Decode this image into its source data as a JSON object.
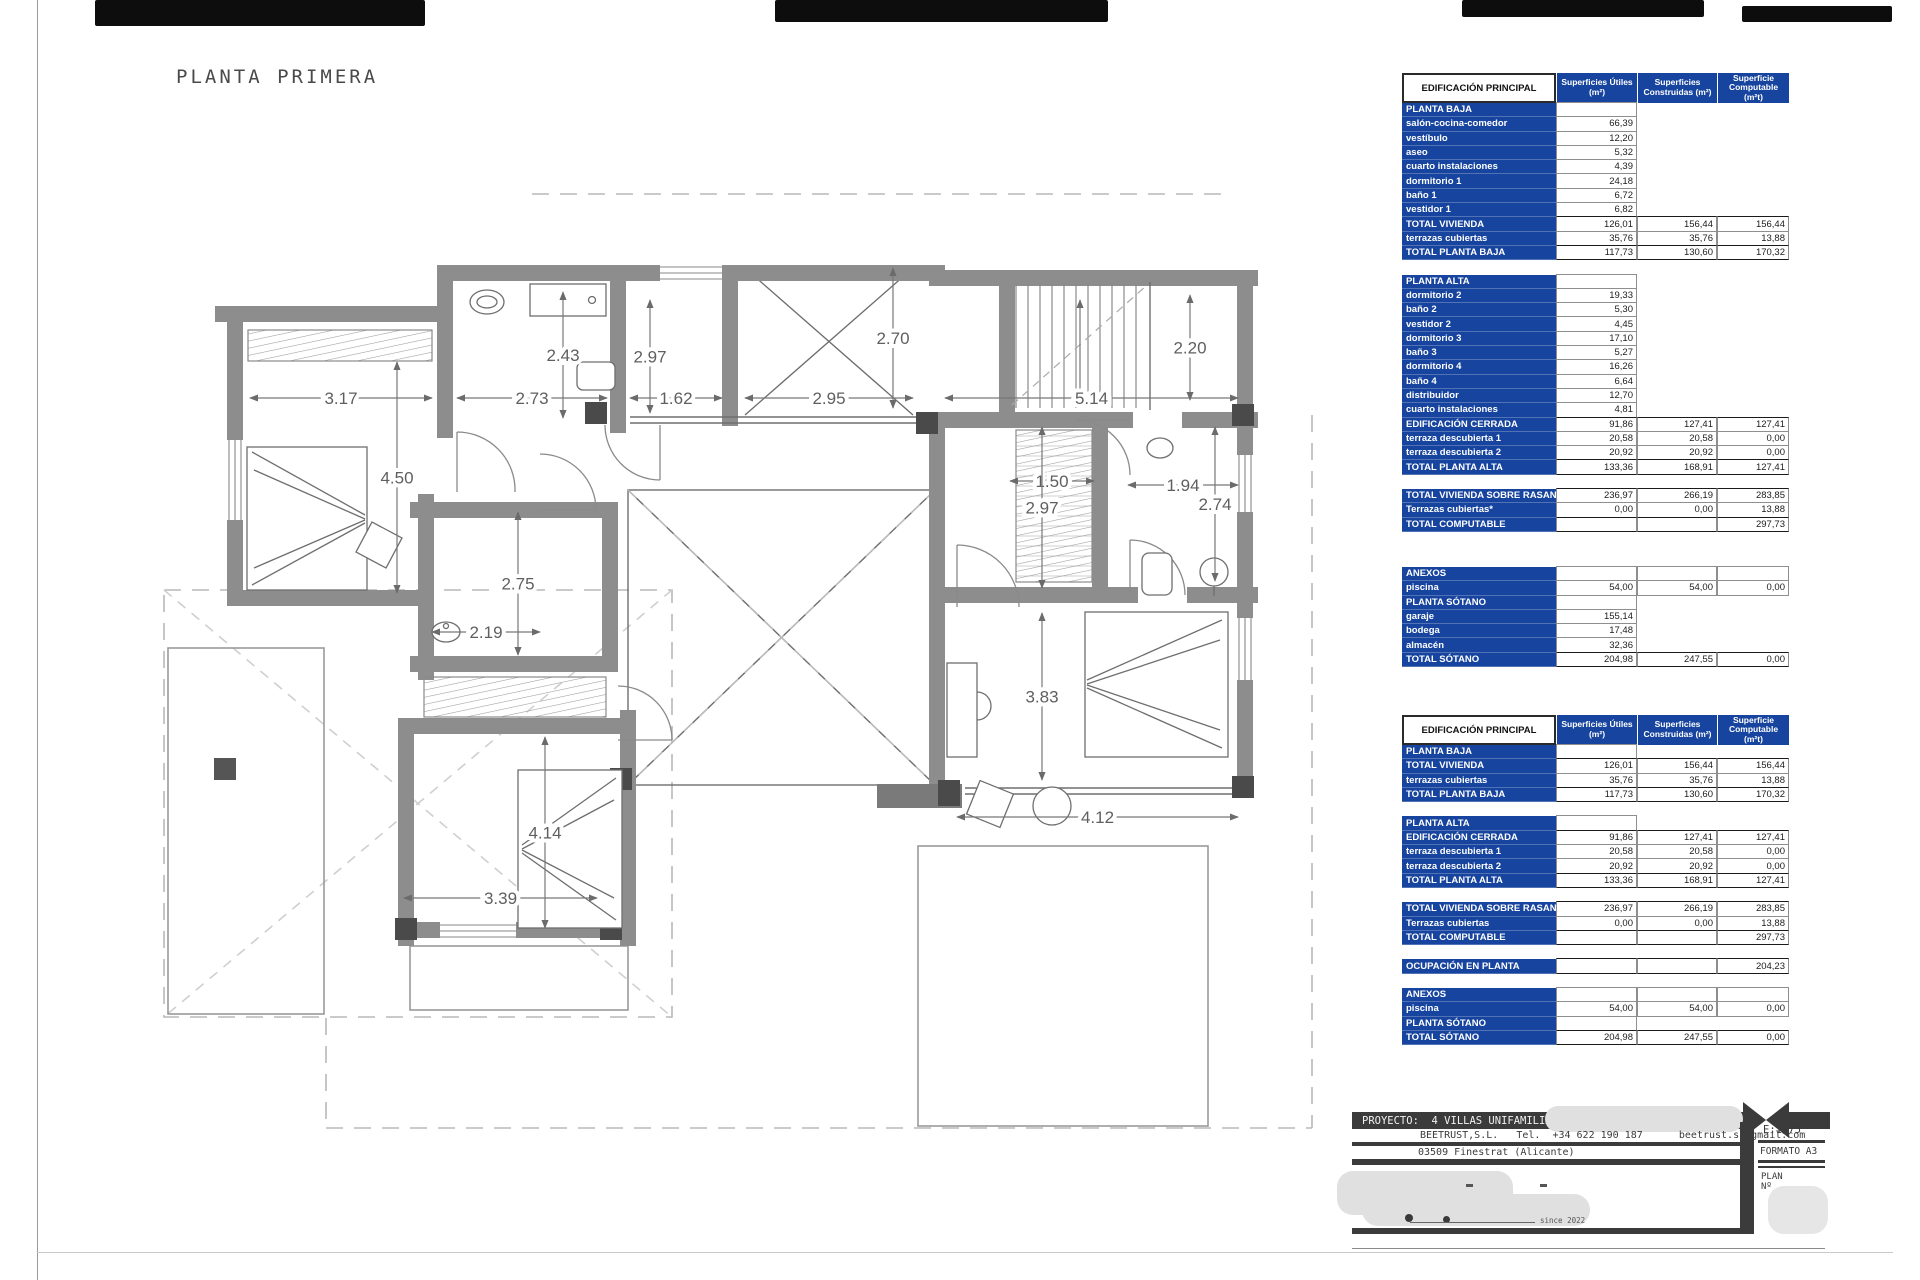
{
  "accent_blue": "#17449e",
  "sheet": {
    "plan_title": "PLANTA PRIMERA"
  },
  "plan": {
    "dimensions": [
      {
        "label": "3.17",
        "x1": 250,
        "y1": 398,
        "x2": 432,
        "y2": 398
      },
      {
        "label": "2.73",
        "x1": 457,
        "y1": 398,
        "x2": 607,
        "y2": 398
      },
      {
        "label": "1.62",
        "x1": 630,
        "y1": 398,
        "x2": 722,
        "y2": 398
      },
      {
        "label": "2.95",
        "x1": 745,
        "y1": 398,
        "x2": 913,
        "y2": 398
      },
      {
        "label": "5.14",
        "x1": 945,
        "y1": 398,
        "x2": 1238,
        "y2": 398
      },
      {
        "label": "2.43",
        "x1": 563,
        "y1": 292,
        "x2": 563,
        "y2": 418
      },
      {
        "label": "2.97",
        "x1": 650,
        "y1": 300,
        "x2": 650,
        "y2": 413
      },
      {
        "label": "2.70",
        "x1": 893,
        "y1": 268,
        "x2": 893,
        "y2": 408
      },
      {
        "label": "2.20",
        "x1": 1190,
        "y1": 295,
        "x2": 1190,
        "y2": 400
      },
      {
        "label": "4.50",
        "x1": 397,
        "y1": 362,
        "x2": 397,
        "y2": 593
      },
      {
        "label": "2.75",
        "x1": 518,
        "y1": 512,
        "x2": 518,
        "y2": 655
      },
      {
        "label": "2.19",
        "x1": 432,
        "y1": 632,
        "x2": 540,
        "y2": 632
      },
      {
        "label": "1.50",
        "x1": 1010,
        "y1": 481,
        "x2": 1094,
        "y2": 481
      },
      {
        "label": "1.94",
        "x1": 1128,
        "y1": 485,
        "x2": 1238,
        "y2": 485
      },
      {
        "label": "2.97",
        "x1": 1042,
        "y1": 427,
        "x2": 1042,
        "y2": 588
      },
      {
        "label": "2.74",
        "x1": 1215,
        "y1": 427,
        "x2": 1215,
        "y2": 581
      },
      {
        "label": "3.83",
        "x1": 1042,
        "y1": 613,
        "x2": 1042,
        "y2": 780
      },
      {
        "label": "4.12",
        "x1": 957,
        "y1": 817,
        "x2": 1238,
        "y2": 817
      },
      {
        "label": "4.14",
        "x1": 545,
        "y1": 737,
        "x2": 545,
        "y2": 928
      },
      {
        "label": "3.39",
        "x1": 404,
        "y1": 898,
        "x2": 597,
        "y2": 898
      }
    ]
  },
  "tables": {
    "corner": "EDIFICACIÓN PRINCIPAL",
    "columns": [
      "Superficies Útiles (m²)",
      "Superficies Construidas (m²)",
      "Superficie Computable (m²t)"
    ],
    "main": [
      {
        "t": "sec",
        "label": "PLANTA BAJA",
        "v": [
          "",
          null,
          null
        ]
      },
      {
        "t": "item",
        "label": "salón-cocina-comedor",
        "v": [
          "66,39",
          null,
          null
        ]
      },
      {
        "t": "item",
        "label": "vestíbulo",
        "v": [
          "12,20",
          null,
          null
        ]
      },
      {
        "t": "item",
        "label": "aseo",
        "v": [
          "5,32",
          null,
          null
        ]
      },
      {
        "t": "item",
        "label": "cuarto instalaciones",
        "v": [
          "4,39",
          null,
          null
        ]
      },
      {
        "t": "item",
        "label": "dormitorio 1",
        "v": [
          "24,18",
          null,
          null
        ]
      },
      {
        "t": "item",
        "label": "baño 1",
        "v": [
          "6,72",
          null,
          null
        ]
      },
      {
        "t": "item",
        "label": "vestidor 1",
        "v": [
          "6,82",
          null,
          null
        ]
      },
      {
        "t": "tot",
        "label": "TOTAL VIVIENDA",
        "v": [
          "126,01",
          "156,44",
          "156,44"
        ]
      },
      {
        "t": "item",
        "label": "terrazas cubiertas",
        "v": [
          "35,76",
          "35,76",
          "13,88"
        ]
      },
      {
        "t": "tot",
        "label": "TOTAL PLANTA BAJA",
        "v": [
          "117,73",
          "130,60",
          "170,32"
        ]
      },
      {
        "t": "gap"
      },
      {
        "t": "sec",
        "label": "PLANTA ALTA",
        "v": [
          "",
          null,
          null
        ]
      },
      {
        "t": "item",
        "label": "dormitorio 2",
        "v": [
          "19,33",
          null,
          null
        ]
      },
      {
        "t": "item",
        "label": "baño 2",
        "v": [
          "5,30",
          null,
          null
        ]
      },
      {
        "t": "item",
        "label": "vestidor 2",
        "v": [
          "4,45",
          null,
          null
        ]
      },
      {
        "t": "item",
        "label": "dormitorio 3",
        "v": [
          "17,10",
          null,
          null
        ]
      },
      {
        "t": "item",
        "label": "baño 3",
        "v": [
          "5,27",
          null,
          null
        ]
      },
      {
        "t": "item",
        "label": "dormitorio 4",
        "v": [
          "16,26",
          null,
          null
        ]
      },
      {
        "t": "item",
        "label": "baño 4",
        "v": [
          "6,64",
          null,
          null
        ]
      },
      {
        "t": "item",
        "label": "distribuidor",
        "v": [
          "12,70",
          null,
          null
        ]
      },
      {
        "t": "item",
        "label": "cuarto instalaciones",
        "v": [
          "4,81",
          null,
          null
        ]
      },
      {
        "t": "tot",
        "label": "EDIFICACIÓN CERRADA",
        "v": [
          "91,86",
          "127,41",
          "127,41"
        ]
      },
      {
        "t": "item",
        "label": "terraza descubierta 1",
        "v": [
          "20,58",
          "20,58",
          "0,00"
        ]
      },
      {
        "t": "item",
        "label": "terraza descubierta 2",
        "v": [
          "20,92",
          "20,92",
          "0,00"
        ]
      },
      {
        "t": "tot",
        "label": "TOTAL PLANTA ALTA",
        "v": [
          "133,36",
          "168,91",
          "127,41"
        ]
      },
      {
        "t": "gap"
      },
      {
        "t": "tot",
        "label": "TOTAL VIVIENDA SOBRE RASANTE",
        "v": [
          "236,97",
          "266,19",
          "283,85"
        ]
      },
      {
        "t": "item",
        "label": "Terrazas cubiertas*",
        "v": [
          "0,00",
          "0,00",
          "13,88"
        ]
      },
      {
        "t": "tot",
        "label": "TOTAL COMPUTABLE",
        "v": [
          "",
          "",
          "297,73"
        ]
      }
    ],
    "anexos": [
      {
        "t": "sec",
        "label": "ANEXOS",
        "v": [
          "",
          "",
          ""
        ]
      },
      {
        "t": "item",
        "label": "piscina",
        "v": [
          "54,00",
          "54,00",
          "0,00"
        ]
      },
      {
        "t": "sec",
        "label": "PLANTA SÓTANO",
        "v": [
          "",
          null,
          null
        ]
      },
      {
        "t": "item",
        "label": "garaje",
        "v": [
          "155,14",
          null,
          null
        ]
      },
      {
        "t": "item",
        "label": "bodega",
        "v": [
          "17,48",
          null,
          null
        ]
      },
      {
        "t": "item",
        "label": "almacén",
        "v": [
          "32,36",
          null,
          null
        ]
      },
      {
        "t": "tot",
        "label": "TOTAL SÓTANO",
        "v": [
          "204,98",
          "247,55",
          "0,00"
        ]
      }
    ],
    "summary": [
      {
        "t": "sec",
        "label": "PLANTA BAJA",
        "v": [
          "",
          null,
          null
        ]
      },
      {
        "t": "tot",
        "label": "TOTAL VIVIENDA",
        "v": [
          "126,01",
          "156,44",
          "156,44"
        ]
      },
      {
        "t": "item",
        "label": "terrazas cubiertas",
        "v": [
          "35,76",
          "35,76",
          "13,88"
        ]
      },
      {
        "t": "tot",
        "label": "TOTAL PLANTA BAJA",
        "v": [
          "117,73",
          "130,60",
          "170,32"
        ]
      },
      {
        "t": "gap"
      },
      {
        "t": "sec",
        "label": "PLANTA ALTA",
        "v": [
          "",
          null,
          null
        ]
      },
      {
        "t": "tot",
        "label": "EDIFICACIÓN CERRADA",
        "v": [
          "91,86",
          "127,41",
          "127,41"
        ]
      },
      {
        "t": "item",
        "label": "terraza descubierta 1",
        "v": [
          "20,58",
          "20,58",
          "0,00"
        ]
      },
      {
        "t": "item",
        "label": "terraza descubierta 2",
        "v": [
          "20,92",
          "20,92",
          "0,00"
        ]
      },
      {
        "t": "tot",
        "label": "TOTAL PLANTA ALTA",
        "v": [
          "133,36",
          "168,91",
          "127,41"
        ]
      },
      {
        "t": "gap"
      },
      {
        "t": "tot",
        "label": "TOTAL VIVIENDA SOBRE RASANTE",
        "v": [
          "236,97",
          "266,19",
          "283,85"
        ]
      },
      {
        "t": "item",
        "label": "Terrazas cubiertas",
        "v": [
          "0,00",
          "0,00",
          "13,88"
        ]
      },
      {
        "t": "tot",
        "label": "TOTAL COMPUTABLE",
        "v": [
          "",
          "",
          "297,73"
        ]
      },
      {
        "t": "gap"
      },
      {
        "t": "tot",
        "label": "OCUPACIÓN EN PLANTA",
        "v": [
          "",
          "",
          "204,23"
        ]
      },
      {
        "t": "gap"
      },
      {
        "t": "sec",
        "label": "ANEXOS",
        "v": [
          "",
          "",
          ""
        ]
      },
      {
        "t": "item",
        "label": "piscina",
        "v": [
          "54,00",
          "54,00",
          "0,00"
        ]
      },
      {
        "t": "sec",
        "label": "PLANTA SÓTANO",
        "v": [
          "",
          null,
          null
        ]
      },
      {
        "t": "tot",
        "label": "TOTAL SÓTANO",
        "v": [
          "204,98",
          "247,55",
          "0,00"
        ]
      }
    ]
  },
  "titleblock": {
    "proyecto": "PROYECTO:  4 VILLAS UNIFAMILIARES EN",
    "contact": "BEETRUST,S.L.   Tel.  +34 622 190 187      beetrust.sl@gmail.com",
    "address": "03509 Finestrat (Alicante)",
    "scale": "E:1/75",
    "formato": "FORMATO A3",
    "plan_label": "PLAN",
    "plan_no": "Nº",
    "since": "since 2022"
  }
}
